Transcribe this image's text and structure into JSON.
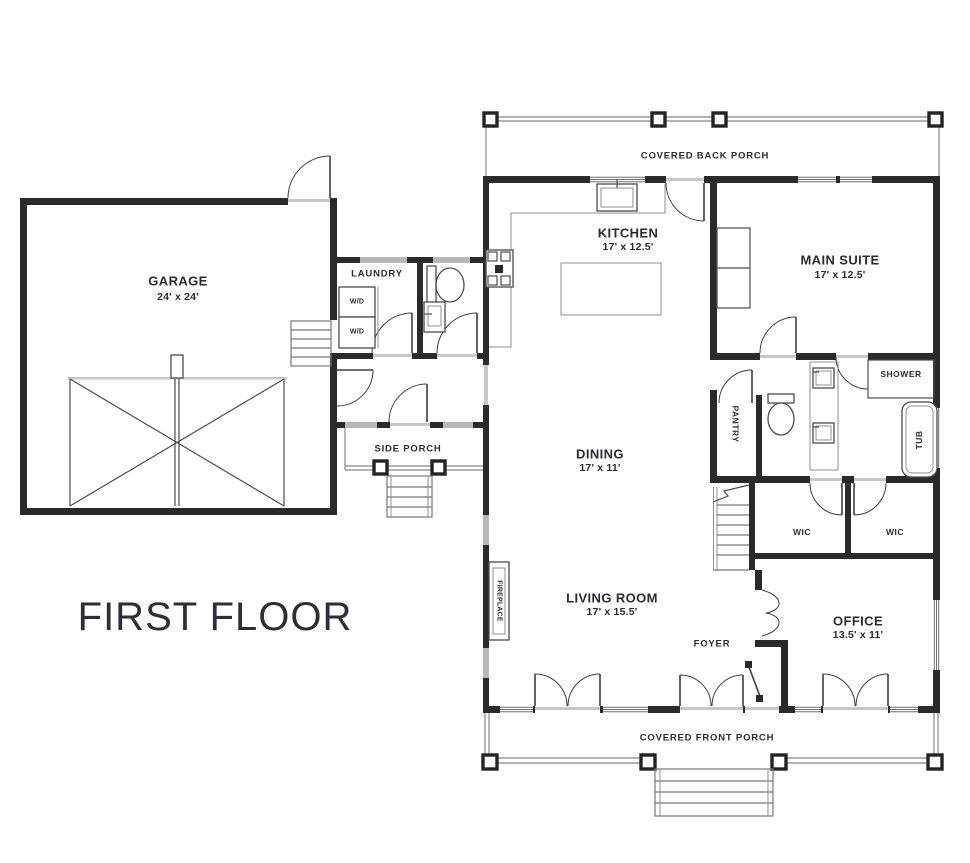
{
  "title": "FIRST FLOOR",
  "labels": {
    "garage": {
      "name": "GARAGE",
      "dims": "24' x 24'"
    },
    "kitchen": {
      "name": "KITCHEN",
      "dims": "17' x 12.5'"
    },
    "main_suite": {
      "name": "MAIN SUITE",
      "dims": "17' x 12.5'"
    },
    "dining": {
      "name": "DINING",
      "dims": "17' x 11'"
    },
    "living_room": {
      "name": "LIVING ROOM",
      "dims": "17' x 15.5'"
    },
    "office": {
      "name": "OFFICE",
      "dims": "13.5' x 11'"
    },
    "laundry": "LAUNDRY",
    "foyer": "FOYER",
    "pantry": "PANTRY",
    "shower": "SHOWER",
    "tub": "TUB",
    "wic_left": "WIC",
    "wic_right": "WIC",
    "fireplace": "FIREPLACE",
    "washer_dryer_top": "W/D",
    "washer_dryer_bottom": "W/D",
    "side_porch": "SIDE PORCH",
    "back_porch": "COVERED BACK PORCH",
    "front_porch": "COVERED FRONT PORCH"
  },
  "colors": {
    "wall": "#2a2a2a",
    "label": "#2b2b33",
    "fixture": "#4c4c4c",
    "light_gray": "#9a9a9a",
    "background": "#ffffff"
  }
}
